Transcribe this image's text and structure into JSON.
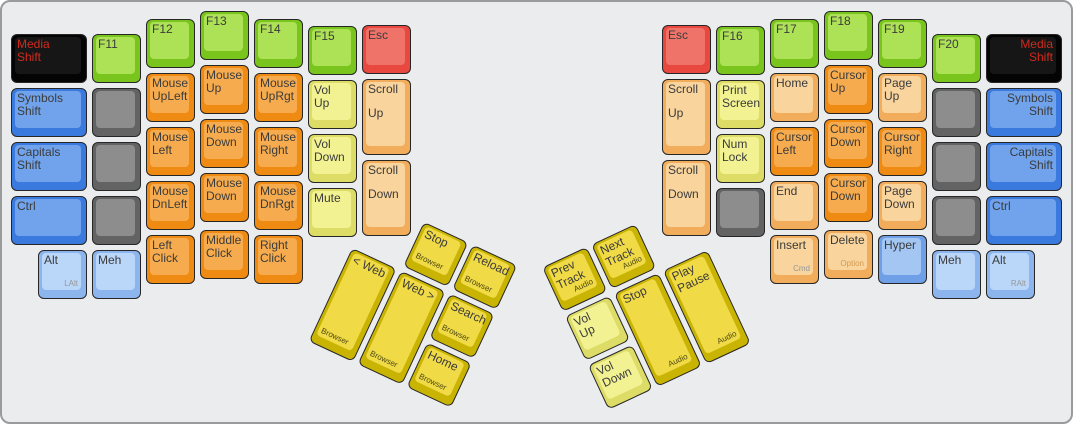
{
  "window": {
    "background": "#ebeced",
    "border_color": "#9b9b9b",
    "width": 1073,
    "height": 424,
    "unit": 54
  },
  "palette": {
    "green": {
      "side": "#79C41D",
      "face": "#AEE256"
    },
    "red": {
      "side": "#E8483F",
      "face": "#F0736A"
    },
    "orange": {
      "side": "#EF8A12",
      "face": "#F6AC4E"
    },
    "peach": {
      "side": "#F2AD5C",
      "face": "#F9D49D"
    },
    "yellow": {
      "side": "#DCDC67",
      "face": "#F2F293"
    },
    "dkyellow": {
      "side": "#C9B404",
      "face": "#F0DA45"
    },
    "blue": {
      "side": "#3A79DD",
      "face": "#71A3EC"
    },
    "ltblue": {
      "side": "#8CB4ED",
      "face": "#BAD6F8"
    },
    "medblue": {
      "side": "#6F9FE6",
      "face": "#A3C6F3"
    },
    "gray": {
      "side": "#636363",
      "face": "#8D8D8D"
    },
    "black": {
      "side": "#040404",
      "face": "#161616"
    }
  },
  "text": {
    "default": "#3B3B3B",
    "media": "#D02A1E",
    "sub": "#979797",
    "option": "#D29A52",
    "thumb": "#4E4A14"
  },
  "left_main": {
    "ox": 9,
    "oy": 9,
    "keys": [
      {
        "x": 0,
        "y": 0.42,
        "w": 1.5,
        "c": "black",
        "l": [
          "Media",
          "Shift"
        ],
        "tc": "media"
      },
      {
        "x": 1.5,
        "y": 0.42,
        "c": "green",
        "l": [
          "F11"
        ]
      },
      {
        "x": 2.5,
        "y": 0.15,
        "c": "green",
        "l": [
          "F12"
        ]
      },
      {
        "x": 3.5,
        "y": 0,
        "c": "green",
        "l": [
          "F13"
        ]
      },
      {
        "x": 4.5,
        "y": 0.15,
        "c": "green",
        "l": [
          "F14"
        ]
      },
      {
        "x": 5.5,
        "y": 0.28,
        "c": "green",
        "l": [
          "F15"
        ]
      },
      {
        "x": 6.5,
        "y": 0.26,
        "c": "red",
        "l": [
          "Esc"
        ]
      },
      {
        "x": 0,
        "y": 1.42,
        "w": 1.5,
        "c": "blue",
        "l": [
          "Symbols",
          "Shift"
        ]
      },
      {
        "x": 1.5,
        "y": 1.42,
        "c": "gray",
        "l": []
      },
      {
        "x": 2.5,
        "y": 1.15,
        "c": "orange",
        "l": [
          "Mouse",
          "UpLeft"
        ]
      },
      {
        "x": 3.5,
        "y": 1,
        "c": "orange",
        "l": [
          "Mouse",
          "Up"
        ]
      },
      {
        "x": 4.5,
        "y": 1.15,
        "c": "orange",
        "l": [
          "Mouse",
          "UpRgt"
        ]
      },
      {
        "x": 5.5,
        "y": 1.28,
        "c": "yellow",
        "l": [
          "Vol",
          "Up"
        ]
      },
      {
        "x": 6.5,
        "y": 1.26,
        "h": 1.5,
        "c": "peach",
        "l": [
          "Scroll",
          "Up"
        ],
        "gap": true
      },
      {
        "x": 0,
        "y": 2.42,
        "w": 1.5,
        "c": "blue",
        "l": [
          "Capitals",
          "Shift"
        ]
      },
      {
        "x": 1.5,
        "y": 2.42,
        "c": "gray",
        "l": []
      },
      {
        "x": 2.5,
        "y": 2.15,
        "c": "orange",
        "l": [
          "Mouse",
          "Left"
        ]
      },
      {
        "x": 3.5,
        "y": 2,
        "c": "orange",
        "l": [
          "Mouse",
          "Down"
        ]
      },
      {
        "x": 4.5,
        "y": 2.15,
        "c": "orange",
        "l": [
          "Mouse",
          "Right"
        ]
      },
      {
        "x": 5.5,
        "y": 2.28,
        "c": "yellow",
        "l": [
          "Vol",
          "Down"
        ]
      },
      {
        "x": 6.5,
        "y": 2.76,
        "h": 1.5,
        "c": "peach",
        "l": [
          "Scroll",
          "Down"
        ],
        "gap": true
      },
      {
        "x": 0,
        "y": 3.42,
        "w": 1.5,
        "c": "blue",
        "l": [
          "Ctrl"
        ]
      },
      {
        "x": 1.5,
        "y": 3.42,
        "c": "gray",
        "l": []
      },
      {
        "x": 2.5,
        "y": 3.15,
        "c": "orange",
        "l": [
          "Mouse",
          "DnLeft"
        ]
      },
      {
        "x": 3.5,
        "y": 3,
        "c": "orange",
        "l": [
          "Mouse",
          "Down"
        ]
      },
      {
        "x": 4.5,
        "y": 3.15,
        "c": "orange",
        "l": [
          "Mouse",
          "DnRgt"
        ]
      },
      {
        "x": 5.5,
        "y": 3.28,
        "c": "yellow",
        "l": [
          "Mute"
        ]
      },
      {
        "x": 0.5,
        "y": 4.42,
        "c": "ltblue",
        "l": [
          "Alt"
        ],
        "sub": "LAlt",
        "subpos": "br"
      },
      {
        "x": 1.5,
        "y": 4.42,
        "c": "ltblue",
        "l": [
          "Meh"
        ]
      },
      {
        "x": 2.5,
        "y": 4.15,
        "c": "orange",
        "l": [
          "Left",
          "Click"
        ]
      },
      {
        "x": 3.5,
        "y": 4.05,
        "c": "orange",
        "l": [
          "Middle",
          "Click"
        ]
      },
      {
        "x": 4.5,
        "y": 4.15,
        "c": "orange",
        "l": [
          "Right",
          "Click"
        ]
      }
    ]
  },
  "right_main": {
    "ox": 660,
    "oy": 9,
    "keys": [
      {
        "x": 0,
        "y": 0.26,
        "c": "red",
        "l": [
          "Esc"
        ]
      },
      {
        "x": 1,
        "y": 0.28,
        "c": "green",
        "l": [
          "F16"
        ]
      },
      {
        "x": 2,
        "y": 0.15,
        "c": "green",
        "l": [
          "F17"
        ]
      },
      {
        "x": 3,
        "y": 0,
        "c": "green",
        "l": [
          "F18"
        ]
      },
      {
        "x": 4,
        "y": 0.15,
        "c": "green",
        "l": [
          "F19"
        ]
      },
      {
        "x": 5,
        "y": 0.42,
        "c": "green",
        "l": [
          "F20"
        ]
      },
      {
        "x": 6,
        "y": 0.42,
        "w": 1.5,
        "c": "black",
        "l": [
          "Media",
          "Shift"
        ],
        "tc": "media",
        "align": "right"
      },
      {
        "x": 0,
        "y": 1.26,
        "h": 1.5,
        "c": "peach",
        "l": [
          "Scroll",
          "Up"
        ],
        "gap": true
      },
      {
        "x": 1,
        "y": 1.28,
        "c": "yellow",
        "l": [
          "Print",
          "Screen"
        ]
      },
      {
        "x": 2,
        "y": 1.15,
        "c": "peach",
        "l": [
          "Home"
        ]
      },
      {
        "x": 3,
        "y": 1,
        "c": "orange",
        "l": [
          "Cursor",
          "Up"
        ]
      },
      {
        "x": 4,
        "y": 1.15,
        "c": "peach",
        "l": [
          "Page",
          "Up"
        ]
      },
      {
        "x": 5,
        "y": 1.42,
        "c": "gray",
        "l": []
      },
      {
        "x": 6,
        "y": 1.42,
        "w": 1.5,
        "c": "blue",
        "l": [
          "Symbols",
          "Shift"
        ],
        "align": "right"
      },
      {
        "x": 0,
        "y": 2.76,
        "h": 1.5,
        "c": "peach",
        "l": [
          "Scroll",
          "Down"
        ],
        "gap": true
      },
      {
        "x": 1,
        "y": 2.28,
        "c": "yellow",
        "l": [
          "Num",
          "Lock"
        ]
      },
      {
        "x": 2,
        "y": 2.15,
        "c": "orange",
        "l": [
          "Cursor",
          "Left"
        ]
      },
      {
        "x": 3,
        "y": 2,
        "c": "orange",
        "l": [
          "Cursor",
          "Down"
        ]
      },
      {
        "x": 4,
        "y": 2.15,
        "c": "orange",
        "l": [
          "Cursor",
          "Right"
        ]
      },
      {
        "x": 5,
        "y": 2.42,
        "c": "gray",
        "l": []
      },
      {
        "x": 6,
        "y": 2.42,
        "w": 1.5,
        "c": "blue",
        "l": [
          "Capitals",
          "Shift"
        ],
        "align": "right"
      },
      {
        "x": 1,
        "y": 3.28,
        "c": "gray",
        "l": []
      },
      {
        "x": 2,
        "y": 3.15,
        "c": "peach",
        "l": [
          "End"
        ]
      },
      {
        "x": 3,
        "y": 3,
        "c": "orange",
        "l": [
          "Cursor",
          "Down"
        ]
      },
      {
        "x": 4,
        "y": 3.15,
        "c": "peach",
        "l": [
          "Page",
          "Down"
        ]
      },
      {
        "x": 5,
        "y": 3.42,
        "c": "gray",
        "l": []
      },
      {
        "x": 6,
        "y": 3.42,
        "w": 1.5,
        "c": "blue",
        "l": [
          "Ctrl"
        ]
      },
      {
        "x": 2,
        "y": 4.15,
        "c": "peach",
        "l": [
          "Insert"
        ],
        "sub": "Cmd",
        "subpos": "br"
      },
      {
        "x": 3,
        "y": 4.05,
        "c": "peach",
        "l": [
          "Delete"
        ],
        "sub": "Option",
        "subpos": "br",
        "subc": "option"
      },
      {
        "x": 4,
        "y": 4.15,
        "c": "medblue",
        "l": [
          "Hyper"
        ]
      },
      {
        "x": 5,
        "y": 4.42,
        "c": "ltblue",
        "l": [
          "Meh"
        ]
      },
      {
        "x": 6,
        "y": 4.42,
        "c": "ltblue",
        "l": [
          "Alt"
        ],
        "sub": "RAlt",
        "subpos": "br"
      }
    ]
  },
  "left_thumb": {
    "left": 373,
    "top": 197,
    "rotation": 25,
    "keys": [
      {
        "x": 1,
        "y": 0,
        "c": "dkyellow",
        "l": [
          "Stop"
        ],
        "sub": "Browser",
        "subpos": "bl",
        "subc": "thumb"
      },
      {
        "x": 2,
        "y": 0,
        "c": "dkyellow",
        "l": [
          "Reload"
        ],
        "sub": "Browser",
        "subpos": "bl",
        "subc": "thumb"
      },
      {
        "x": 0,
        "y": 1,
        "h": 2,
        "c": "dkyellow",
        "l": [
          "< Web"
        ],
        "sub": "Browser",
        "subpos": "bl",
        "subc": "thumb"
      },
      {
        "x": 1,
        "y": 1,
        "h": 2,
        "c": "dkyellow",
        "l": [
          "Web >"
        ],
        "sub": "Browser",
        "subpos": "bl",
        "subc": "thumb"
      },
      {
        "x": 2,
        "y": 1,
        "c": "dkyellow",
        "l": [
          "Search"
        ],
        "sub": "Browser",
        "subpos": "bl",
        "subc": "thumb"
      },
      {
        "x": 2,
        "y": 2,
        "c": "dkyellow",
        "l": [
          "Home"
        ],
        "sub": "Browser",
        "subpos": "bl",
        "subc": "thumb"
      }
    ]
  },
  "right_thumb": {
    "left": 525,
    "top": 197,
    "rotation": -25,
    "keys": [
      {
        "x": 0,
        "y": 0,
        "c": "dkyellow",
        "l": [
          "Prev",
          "Track"
        ],
        "sub": "Audio",
        "subpos": "br",
        "subc": "thumb"
      },
      {
        "x": 1,
        "y": 0,
        "c": "dkyellow",
        "l": [
          "Next",
          "Track"
        ],
        "sub": "Audio",
        "subpos": "br",
        "subc": "thumb"
      },
      {
        "x": 0,
        "y": 1,
        "c": "yellow",
        "l": [
          "Vol",
          "Up"
        ]
      },
      {
        "x": 1,
        "y": 1,
        "h": 2,
        "c": "dkyellow",
        "l": [
          "Stop"
        ],
        "sub": "Audio",
        "subpos": "br",
        "subc": "thumb"
      },
      {
        "x": 2,
        "y": 1,
        "h": 2,
        "c": "dkyellow",
        "l": [
          "Play",
          "Pause"
        ],
        "sub": "Audio",
        "subpos": "br",
        "subc": "thumb"
      },
      {
        "x": 0,
        "y": 2,
        "c": "yellow",
        "l": [
          "Vol",
          "Down"
        ]
      }
    ]
  }
}
